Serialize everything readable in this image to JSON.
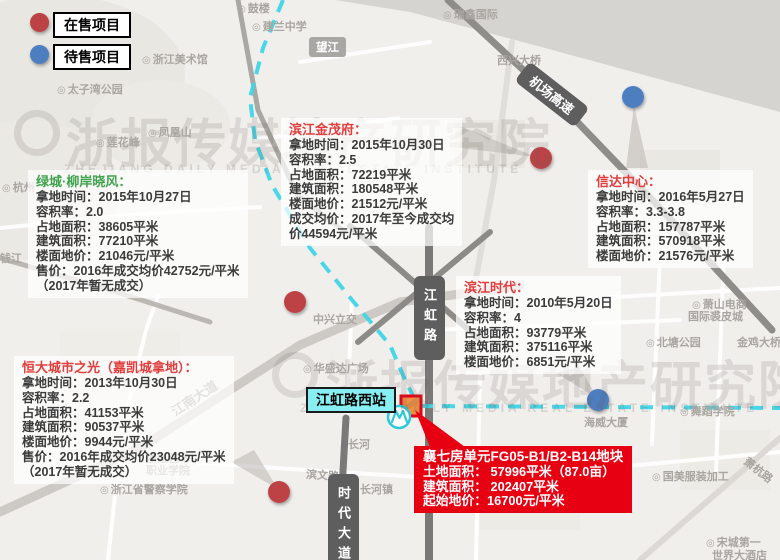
{
  "legend": {
    "items": [
      {
        "label": "在售项目",
        "color": "#bc4245"
      },
      {
        "label": "待售项目",
        "color": "#4d7ec0"
      }
    ]
  },
  "watermark": {
    "cn": "浙报传媒地产研究院",
    "en": "ZHEJIANG DAILY MEDIA REAL ESTATE INSTITUTE"
  },
  "station": {
    "label": "江虹路西站"
  },
  "road_labels": {
    "jianghong": "江虹路",
    "shidai": "时代大道",
    "jichang": "机场高速",
    "wangjiang": "望江",
    "jiangnan": "江南大道",
    "binwen": "滨文路",
    "xiaohang": "萧杭路"
  },
  "projects": [
    {
      "name": "绿城柳岸晓风",
      "title": "绿城·柳岸晓风：",
      "color": "green",
      "lines": [
        "拿地时间：2015年10月27日",
        "容积率：2.0",
        "占地面积：38605平米",
        "建筑面积：77210平米",
        "楼面地价：21046元/平米",
        "售价：2016年成交均价42752元/平米",
        "（2017年暂无成交）"
      ]
    },
    {
      "name": "滨江金茂府",
      "title": "滨江金茂府：",
      "color": "red",
      "lines": [
        "拿地时间：2015年10月30日",
        "容积率：2.5",
        "占地面积：72219平米",
        "建筑面积：180548平米",
        "楼面地价：21512元/平米",
        "成交均价：2017年至今成交均",
        "价44594元/平米"
      ]
    },
    {
      "name": "信达中心",
      "title": "信达中心：",
      "color": "red",
      "lines": [
        "拿地时间：2016年5月27日",
        "容积率：3.3-3.8",
        "占地面积：157787平米",
        "建筑面积：570918平米",
        "楼面地价：21576元/平米"
      ]
    },
    {
      "name": "滨江时代",
      "title": "滨江时代：",
      "color": "red",
      "lines": [
        "拿地时间：2010年5月20日",
        "容积率：4",
        "占地面积：93779平米",
        "建筑面积：375116平米",
        "楼面地价：6851元/平米"
      ]
    },
    {
      "name": "恒大城市之光",
      "title": "恒大城市之光（嘉凯城拿地）：",
      "color": "red",
      "lines": [
        "拿地时间：2013年10月30日",
        "容积率：2.2",
        "占地面积：41153平米",
        "建筑面积：90537平米",
        "楼面地价：9944元/平米",
        "售价：2016年成交均价23048元/平米",
        "（2017年暂无成交）"
      ]
    }
  ],
  "plot_callout": {
    "title": "襄七房单元FG05-B1/B2-B14地块",
    "lines": [
      "土地面积： 57996平米（87.0亩）",
      "建筑面积： 202407平米",
      "起始地价：16700元/平米"
    ]
  },
  "markers": [
    {
      "type": "onsale",
      "x": 541,
      "y": 158
    },
    {
      "type": "onsale",
      "x": 295,
      "y": 302
    },
    {
      "type": "onsale",
      "x": 279,
      "y": 492
    },
    {
      "type": "pending",
      "x": 633,
      "y": 97
    },
    {
      "type": "pending",
      "x": 598,
      "y": 400
    }
  ],
  "map_labels": [
    {
      "text": "鼓楼",
      "x": 237,
      "y": 0,
      "icon": true
    },
    {
      "text": "建兰中学",
      "x": 252,
      "y": 18,
      "icon": true
    },
    {
      "text": "浙江美术馆",
      "x": 142,
      "y": 51,
      "icon": true
    },
    {
      "text": "太子湾公园",
      "x": 57,
      "y": 81,
      "icon": true
    },
    {
      "text": "瑞鑫国际",
      "x": 443,
      "y": 6,
      "icon": true
    },
    {
      "text": "西兴大桥",
      "x": 497,
      "y": 52
    },
    {
      "text": "凤凰山",
      "x": 148,
      "y": 124,
      "icon": true
    },
    {
      "text": "莲花峰",
      "x": 96,
      "y": 134,
      "icon": true
    },
    {
      "text": "杭州",
      "x": 2,
      "y": 179,
      "icon": true
    },
    {
      "text": "钱江",
      "x": 0,
      "y": 250
    },
    {
      "text": "中兴立交",
      "x": 313,
      "y": 311
    },
    {
      "text": "华盛达广场",
      "x": 303,
      "y": 360,
      "icon": true
    },
    {
      "text": "长河",
      "x": 348,
      "y": 436
    },
    {
      "text": "长河镇",
      "x": 360,
      "y": 481
    },
    {
      "text": "浙江艺术",
      "x": 146,
      "y": 450
    },
    {
      "text": "职业学院",
      "x": 146,
      "y": 462
    },
    {
      "text": "浙江省警察学院",
      "x": 100,
      "y": 481,
      "icon": true
    },
    {
      "text": "萧山电商",
      "x": 692,
      "y": 296,
      "icon": true
    },
    {
      "text": "国际裘皮城",
      "x": 688,
      "y": 308
    },
    {
      "text": "北塘公园",
      "x": 646,
      "y": 334,
      "icon": true
    },
    {
      "text": "金鸡大桥",
      "x": 737,
      "y": 334
    },
    {
      "text": "舞蹈学院",
      "x": 680,
      "y": 403,
      "icon": true
    },
    {
      "text": "海威大厦",
      "x": 584,
      "y": 414
    },
    {
      "text": "国美服装加工",
      "x": 652,
      "y": 468,
      "icon": true
    },
    {
      "text": "宋城第一",
      "x": 706,
      "y": 534,
      "icon": true
    },
    {
      "text": "世界大酒店",
      "x": 712,
      "y": 547
    }
  ],
  "colors": {
    "onsale": "#bc4245",
    "pending": "#4d7ec0",
    "metro": "#3fd5e8",
    "plot_fill": "#f09045",
    "plot_border": "#e60012",
    "callout_bg": "#e60012"
  }
}
